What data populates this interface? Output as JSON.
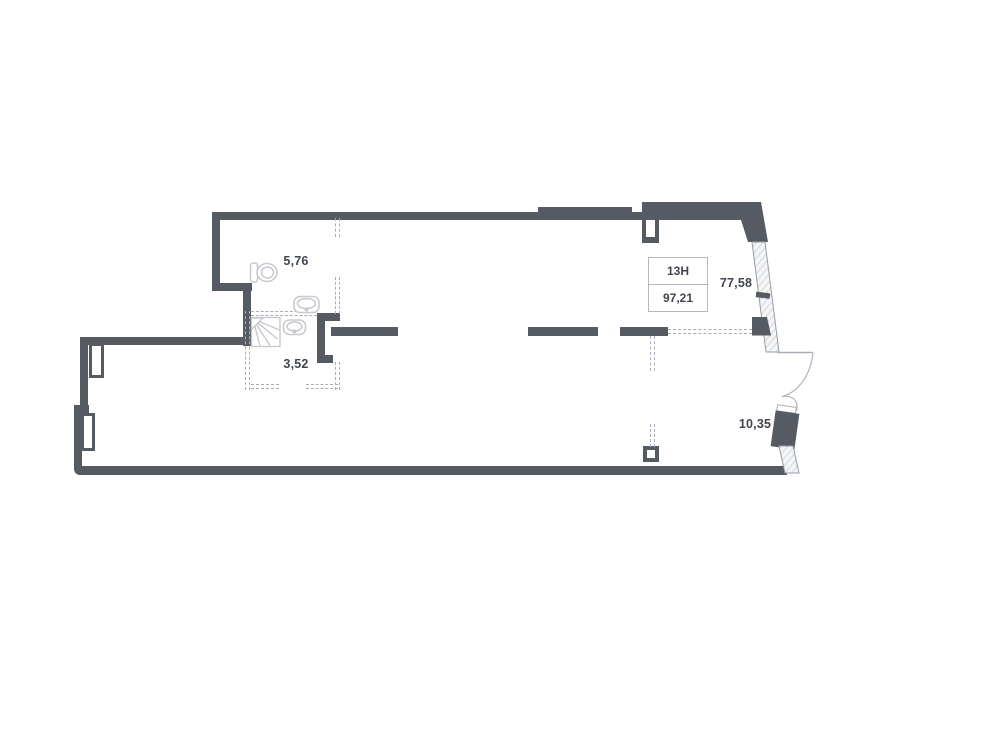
{
  "plan": {
    "unit": {
      "number": "13Н",
      "total_area": "97,21"
    },
    "rooms": {
      "wc_area": "5,76",
      "shower_area": "3,52",
      "living_area": "77,58",
      "balcony_area": "10,35"
    },
    "colors": {
      "wall": "#565a62",
      "fixture_outline": "#c6c9ce",
      "dashed_line": "#a9aeb6",
      "label_text": "#41454e",
      "box_border": "#b4b8be"
    }
  }
}
